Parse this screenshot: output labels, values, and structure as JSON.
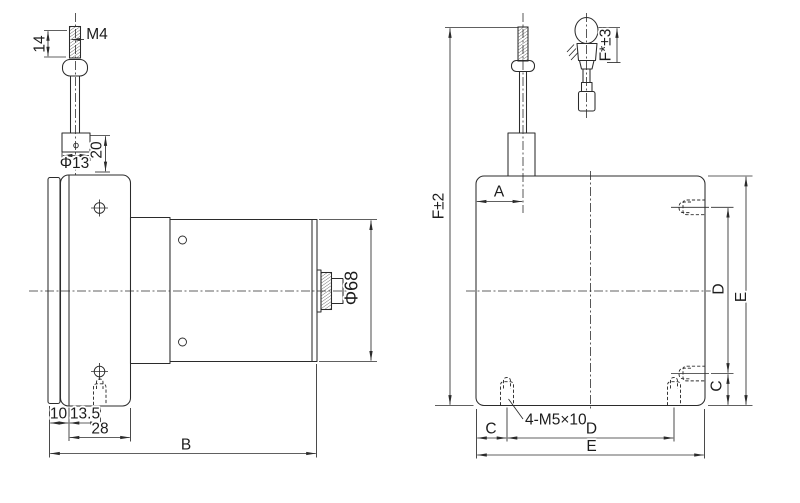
{
  "colors": {
    "line": "#2b2b2b",
    "text": "#1c1c1c",
    "background": "#ffffff"
  },
  "left_view": {
    "thread_length": "14",
    "thread_spec": "M4",
    "bushing_diameter": "Φ13",
    "bushing_height": "20",
    "body_diameter": "Φ68",
    "back_plate_thickness": "10",
    "wire_offset": "13.5",
    "flange_width": "28",
    "total_length": "B"
  },
  "right_view": {
    "overall_height": "F±2",
    "wire_to_edge": "A",
    "fitting_length": "F*±3",
    "side_hole_spacing": "D",
    "side_plate_height": "E",
    "side_hole_to_edge": "C",
    "mounting_holes_callout": "4-M5×10",
    "bottom_hole_to_edge": "C",
    "bottom_hole_spacing": "D",
    "bottom_plate_width": "E"
  }
}
